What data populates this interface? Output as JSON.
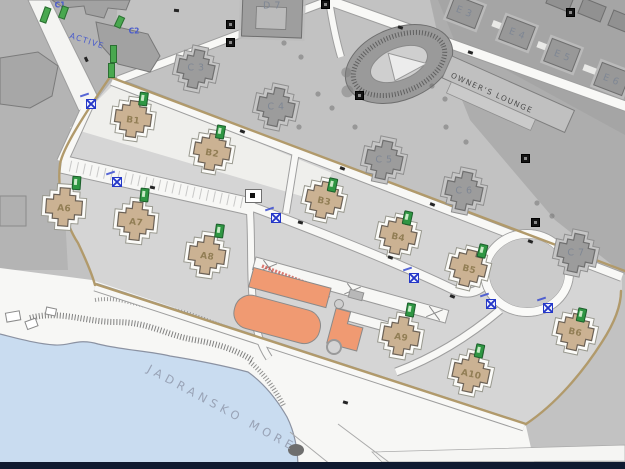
{
  "map": {
    "sea_label": "JADRANSKO MORE",
    "owners_lounge": "OWNER'S LOUNGE",
    "zones": {
      "c1": "C1",
      "c2": "C2",
      "active": "ACTIVE"
    },
    "villas_a": [
      "A6",
      "A7",
      "A8",
      "A9",
      "A10"
    ],
    "villas_b": [
      "B1",
      "B2",
      "B3",
      "B4",
      "B5",
      "B6"
    ],
    "context": [
      "C 3",
      "C 4",
      "C 5",
      "C 6",
      "C 7",
      "D 7",
      "E 3",
      "E 4",
      "E 5",
      "E 6"
    ],
    "colors": {
      "sea": "#c9dcf0",
      "villa_tan": "#cbb293",
      "orange_building": "#f09a72",
      "site_boundary_tan": "#b19a6b",
      "marker_green": "#2f9643",
      "marker_blue": "#2437c8",
      "zone_label_blue": "#4a5ccc",
      "navy_strip": "#0f1a30"
    }
  }
}
